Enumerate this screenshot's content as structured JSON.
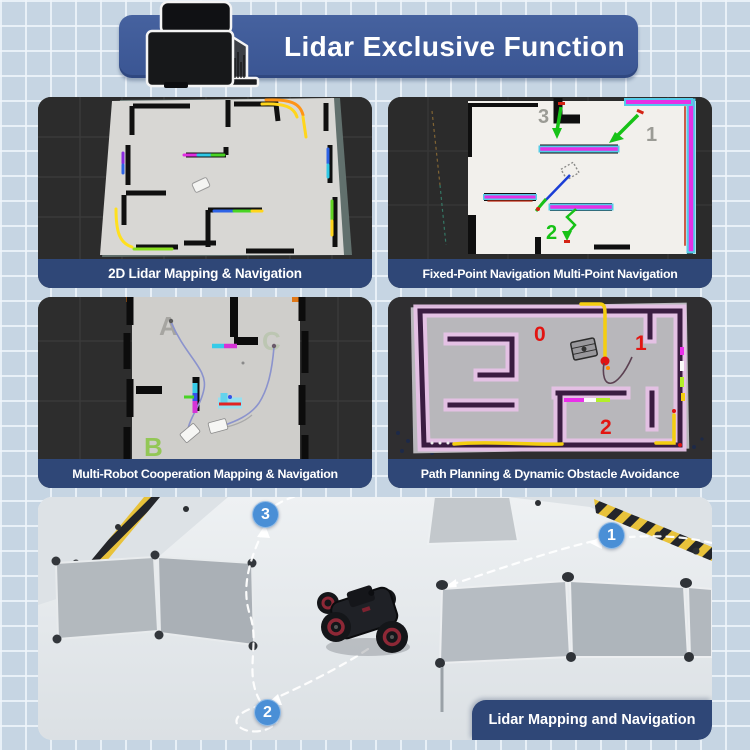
{
  "header": {
    "title": "Lidar Exclusive Function"
  },
  "panels": [
    {
      "caption": "2D Lidar Mapping & Navigation"
    },
    {
      "caption": "Fixed-Point Navigation Multi-Point Navigation",
      "waypoint_labels": {
        "p1": "1",
        "p2": "2",
        "p3": "3"
      }
    },
    {
      "caption": "Multi-Robot Cooperation Mapping & Navigation",
      "robot_labels": {
        "a": "A",
        "b": "B",
        "c": "C"
      }
    },
    {
      "caption": "Path Planning & Dynamic Obstacle Avoidance",
      "zone_labels": {
        "z0": "0",
        "z1": "1",
        "z2": "2"
      }
    }
  ],
  "photo": {
    "caption": "Lidar Mapping and Navigation",
    "waypoints": {
      "w1": "1",
      "w2": "2",
      "w3": "3"
    }
  },
  "colors": {
    "background": "#c6d5e3",
    "banner_blue": "#46629f",
    "caption_bar_blue": "#2f4777",
    "badge_blue": "#4a8fd6",
    "title_text": "#ffffff"
  }
}
